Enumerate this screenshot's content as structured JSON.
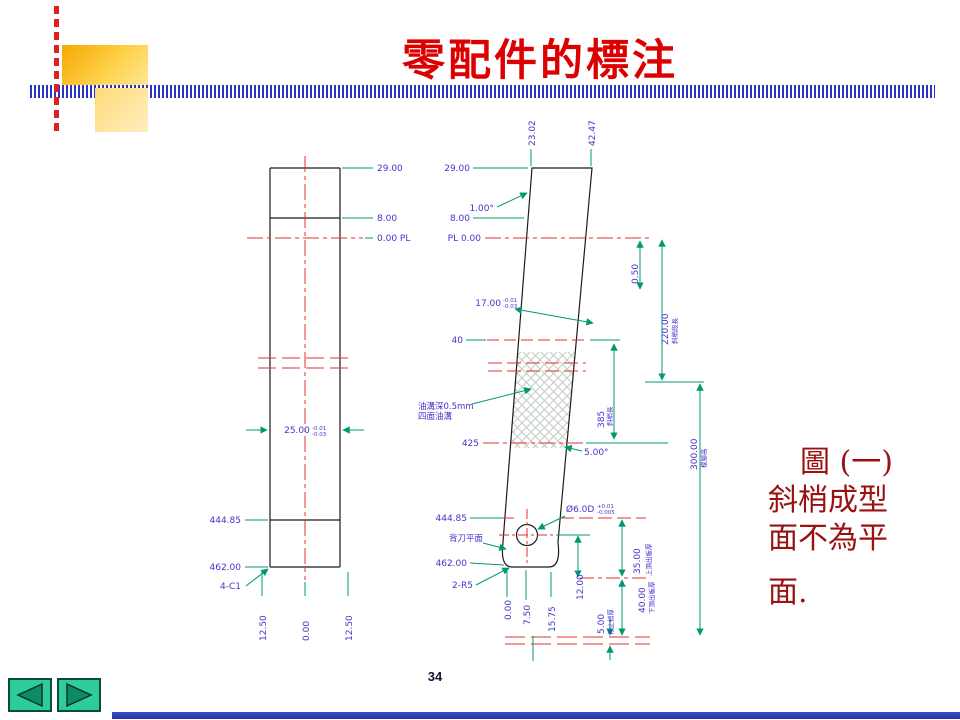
{
  "header": {
    "title": "零配件的標注"
  },
  "caption": {
    "line1": "圖 (一)",
    "line2": "斜梢成型",
    "line3": "面不為平",
    "line4": "面."
  },
  "footer": {
    "page_number": "34"
  },
  "left_view": {
    "dim_29": "29.00",
    "dim_8": "8.00",
    "dim_pl": "0.00 PL",
    "dim_25": "25.00",
    "tol_25_upper": "-0.01",
    "tol_25_lower": "-0.03",
    "dim_44485": "444.85",
    "dim_462": "462.00",
    "chamfer": "4-C1",
    "base_left": "12.50",
    "base_center": "0.00",
    "base_right": "12.50"
  },
  "right_view": {
    "top_left_offset": "23.02",
    "top_right_offset": "42.47",
    "dim_29": "29.00",
    "angle_1": "1.00°",
    "dim_8": "8.00",
    "dim_pl": "PL 0.00",
    "dim_050": "0.50",
    "dim_17": "17.00",
    "tol_17_upper": "-0.01",
    "tol_17_lower": "-0.03",
    "dim_40": "40",
    "groove_line1": "油溝深0.5mm",
    "groove_line2": "四面油溝",
    "dim_425": "425",
    "angle_5": "5.00°",
    "dim_220": "220.00",
    "note_220": "斜梢段長",
    "dim_385": "385",
    "note_385": "斜梢長",
    "dim_300": "300.00",
    "note_300": "模腳高",
    "hole": "Ø6.0D",
    "tol_hole_upper": "+0.01",
    "tol_hole_lower": "-0.005",
    "back_plane": "背刀平面",
    "dim_44485": "444.85",
    "dim_462": "462.00",
    "corner_r": "2-R5",
    "dim_35": "35.00",
    "note_35": "上頂出板厚",
    "dim_12": "12.00",
    "dim_40b": "40.00",
    "note_40b": "下頂出板厚",
    "dim_5": "5.00",
    "note_5": "停止梢厚",
    "base_0": "0.00",
    "base_75": "7.50",
    "base_1575": "15.75"
  },
  "colors": {
    "title_red": "#dd0000",
    "caption_red": "#991111",
    "dimension_green": "#009973",
    "label_blue": "#4433cc",
    "centerline_red": "#e03030",
    "outline_black": "#1b1b1b",
    "nav_green": "#2ecc98",
    "bar_blue": "#2a35c8"
  }
}
